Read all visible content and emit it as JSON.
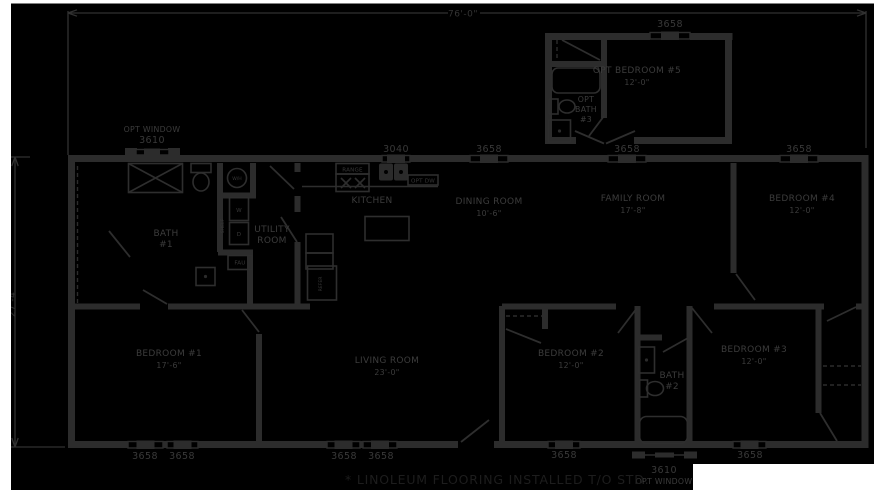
{
  "dims": {
    "width": "76'-0\"",
    "depth": "27'-4\""
  },
  "note": {
    "text": "* LINOLEUM FLOORING INSTALLED T/O STD."
  },
  "windows": {
    "w3658": "3658",
    "w3040": "3040",
    "w3610": "3610",
    "opt_window": "OPT WINDOW"
  },
  "rooms": {
    "opt_bedroom_5": {
      "name": "OPT BEDROOM #5",
      "size": "12'-0\""
    },
    "opt_bath_3": {
      "line1": "OPT",
      "line2": "BATH",
      "line3": "#3"
    },
    "kitchen": {
      "name": "KITCHEN"
    },
    "dining_room": {
      "name": "DINING ROOM",
      "size": "10'-6\""
    },
    "family_room": {
      "name": "FAMILY ROOM",
      "size": "17'-8\""
    },
    "bedroom_4": {
      "name": "BEDROOM #4",
      "size": "12'-0\""
    },
    "bath_1": {
      "line1": "BATH",
      "line2": "#1"
    },
    "utility_room": {
      "line1": "UTILITY",
      "line2": "ROOM"
    },
    "bedroom_1": {
      "name": "BEDROOM #1",
      "size": "17'-6\""
    },
    "living_room": {
      "name": "LIVING ROOM",
      "size": "23'-0\""
    },
    "bedroom_2": {
      "name": "BEDROOM #2",
      "size": "12'-0\""
    },
    "bath_2": {
      "line1": "BATH",
      "line2": "#2"
    },
    "bedroom_3": {
      "name": "BEDROOM #3",
      "size": "12'-0\""
    }
  },
  "fixtures": {
    "range": "RANGE",
    "opt_dw": "OPT DW",
    "refer": "REFER",
    "fau": "FAU",
    "water_heater": "W/H",
    "washer": "W",
    "dryer": "D",
    "shelf": "SHELF"
  }
}
